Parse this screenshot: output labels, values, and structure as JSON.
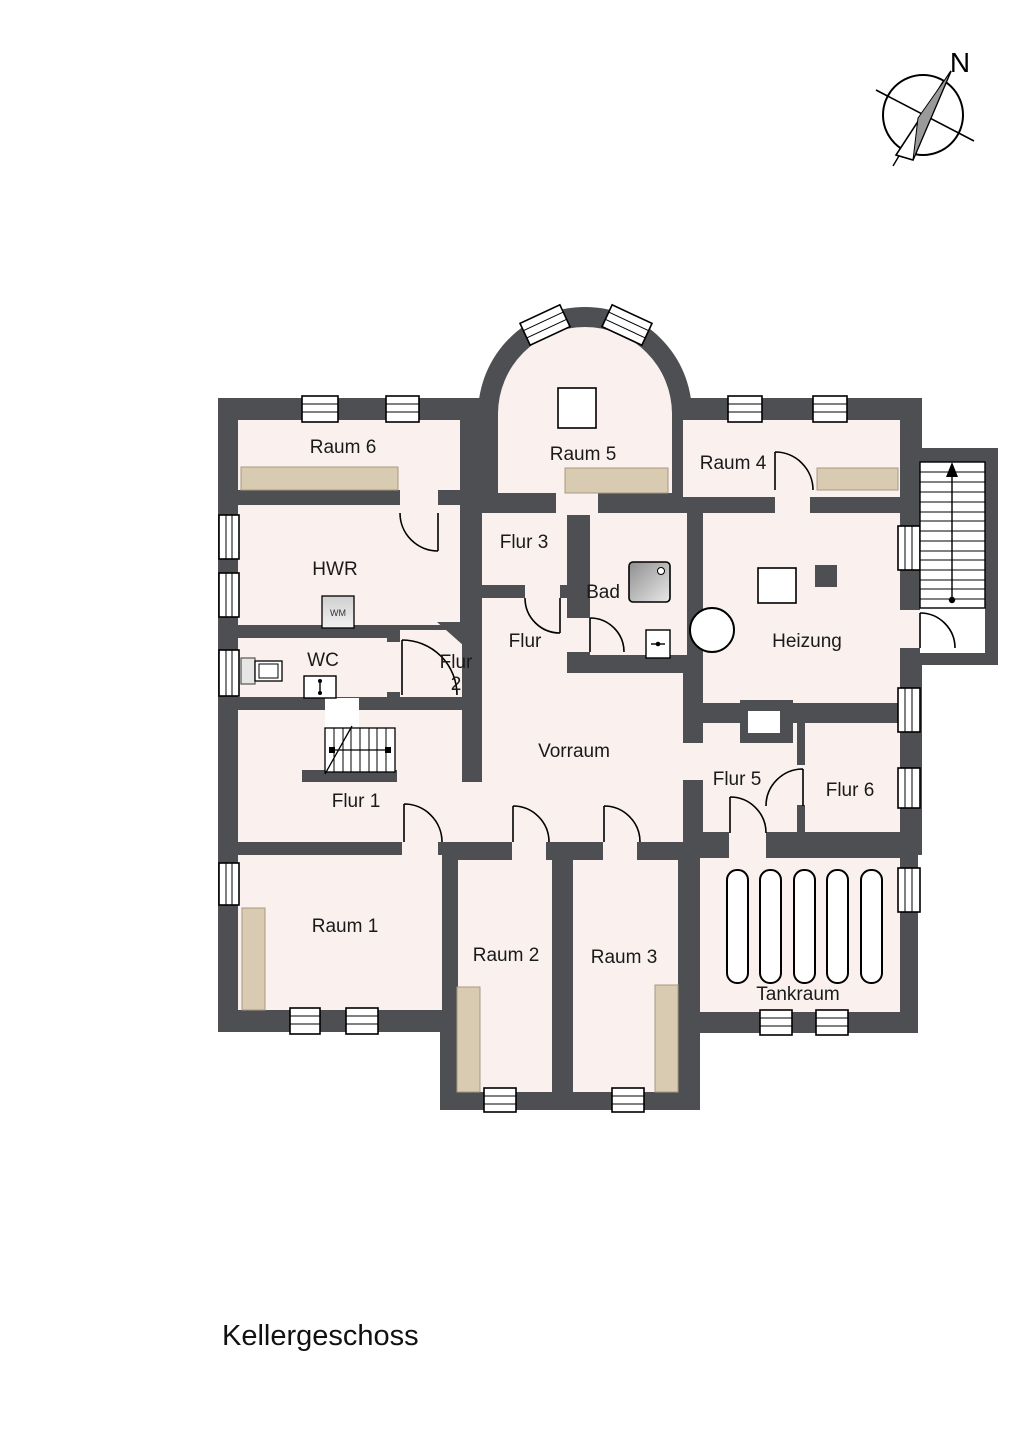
{
  "title": "Kellergeschoss",
  "compass": {
    "north_label": "N"
  },
  "rooms": {
    "raum6": "Raum 6",
    "raum5": "Raum 5",
    "raum4": "Raum 4",
    "hwr": "HWR",
    "flur3": "Flur 3",
    "bad": "Bad",
    "heizung": "Heizung",
    "wc": "WC",
    "flur": "Flur",
    "flur2": "Flur 2",
    "vorraum": "Vorraum",
    "flur1": "Flur 1",
    "flur5": "Flur 5",
    "flur6": "Flur 6",
    "raum1": "Raum 1",
    "raum2": "Raum 2",
    "raum3": "Raum 3",
    "tankraum": "Tankraum"
  },
  "fixtures": {
    "washing_machine": "WM"
  },
  "colors": {
    "wall": "#4e4f52",
    "room": "#faf1ef",
    "furniture": "#d9cbb2",
    "background": "#ffffff"
  }
}
